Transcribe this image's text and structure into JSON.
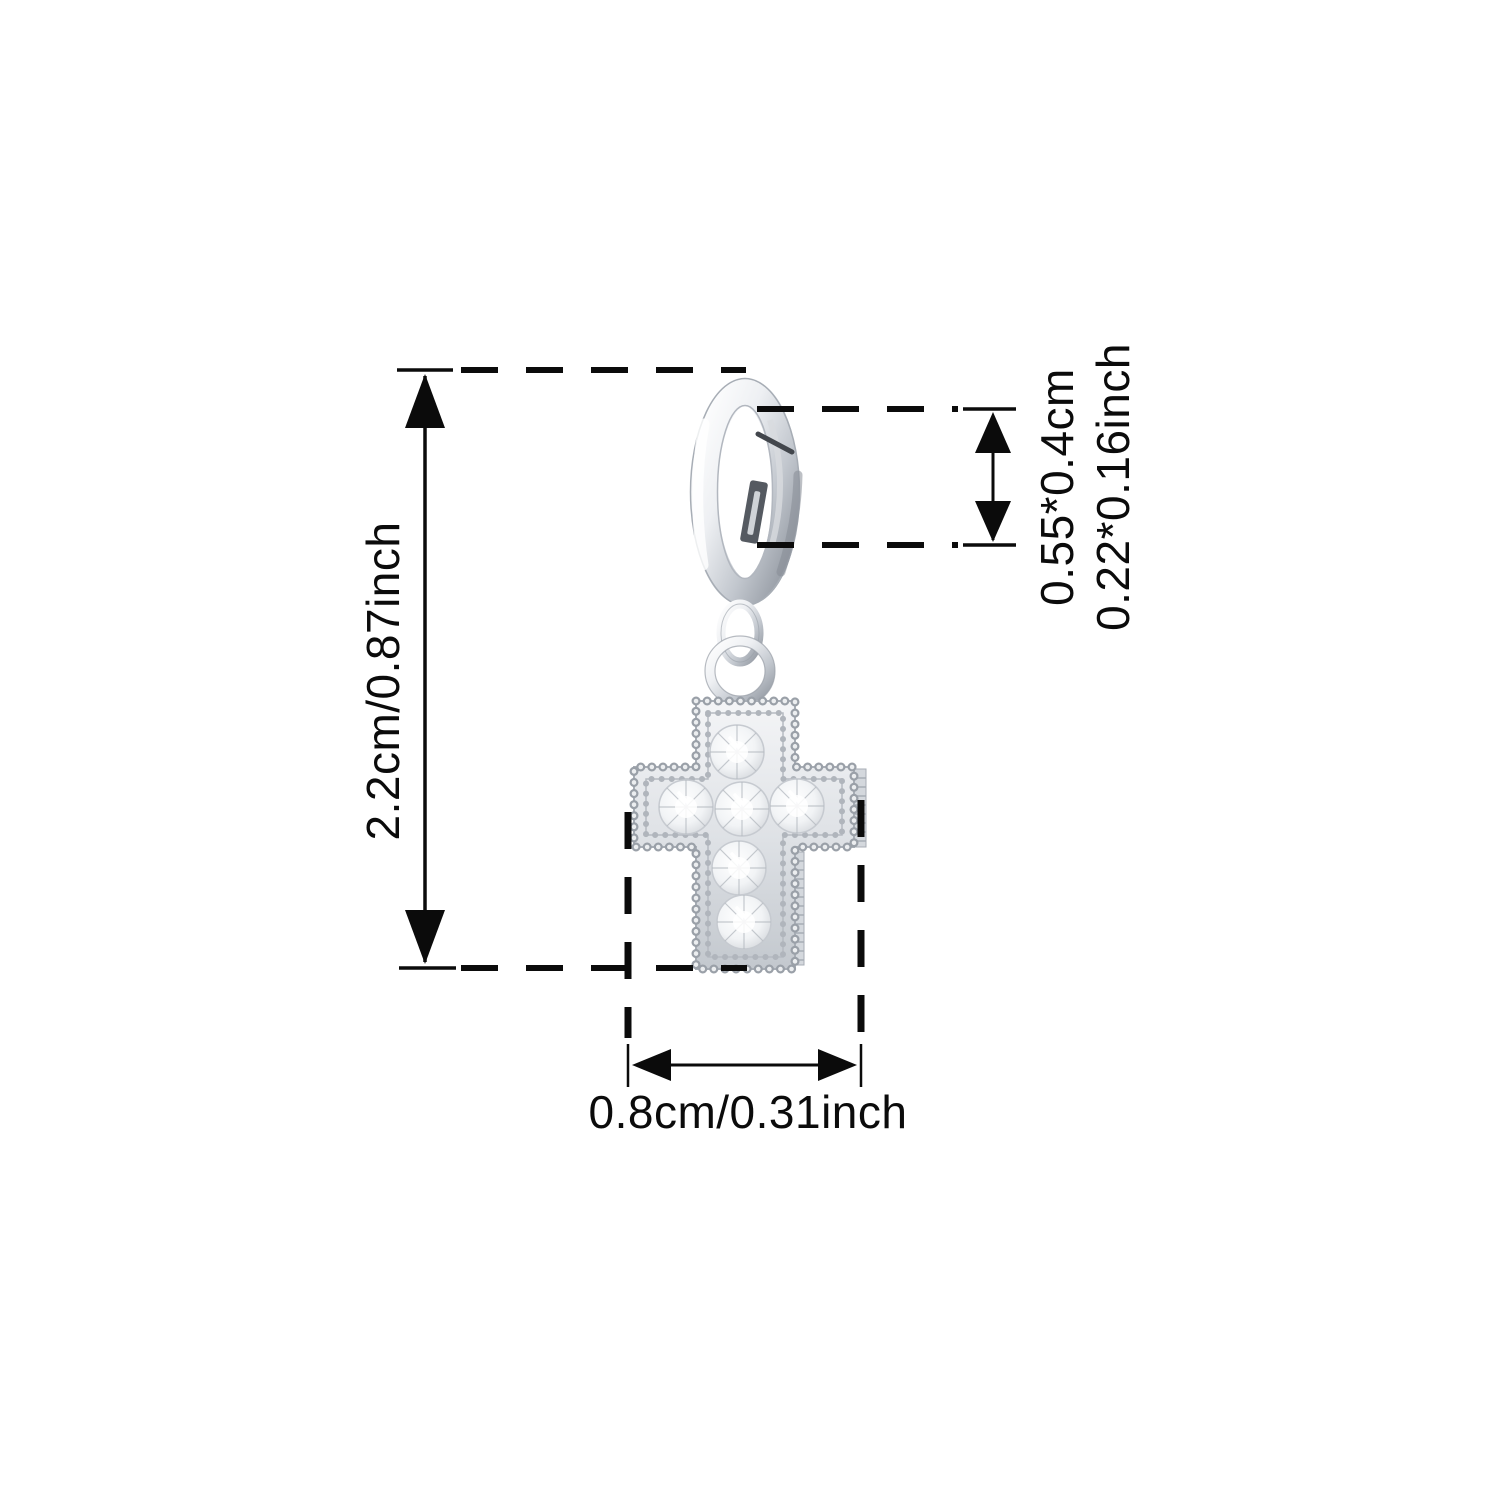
{
  "page": {
    "type": "product-dimension-diagram",
    "product_name": "silver cross charm pendant with round clasp",
    "stone_count": 6
  },
  "colors": {
    "background": "#ffffff",
    "line": "#0b0b0b",
    "metal_light": "#ffffff",
    "metal_mid": "#d7dbdf",
    "metal_dark": "#8f959e",
    "stone_edge": "#c2c7cd"
  },
  "dimensions": {
    "height": {
      "value": "2.2cm/0.87inch",
      "orientation": "vertical"
    },
    "clasp": {
      "line1": "0.55*0.4cm",
      "line2": "0.22*0.16inch",
      "orientation": "vertical"
    },
    "width": {
      "value": "0.8cm/0.31inch",
      "orientation": "horizontal"
    }
  }
}
